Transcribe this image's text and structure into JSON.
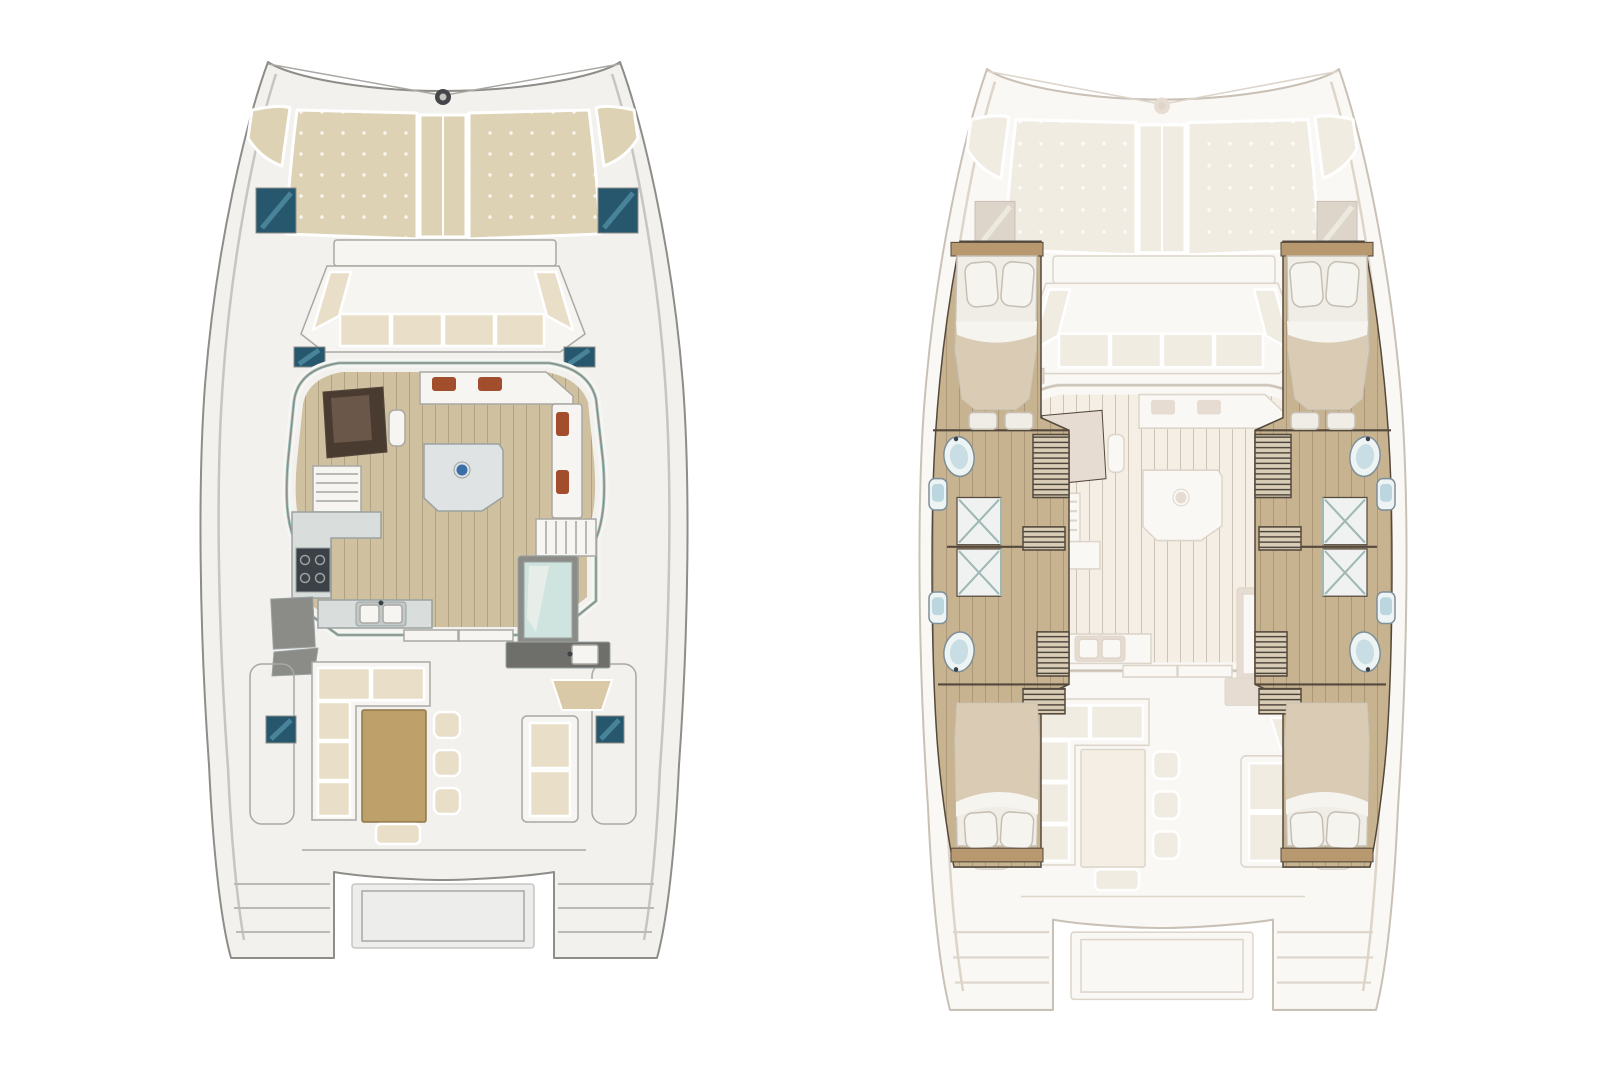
{
  "colors": {
    "background": "#ffffff",
    "hull_fill": "#f2f1ee",
    "hull_line": "#8e8d88",
    "inner_line": "#c6c5c0",
    "detail_line": "#a9a8a3",
    "tread": "#b9b9b5",
    "sunpad": "#ddd2b4",
    "sunpad_line": "#ffffff",
    "hatch_dark": "#26576d",
    "hatch_light": "#4f8ba1",
    "bench_white": "#f6f5f2",
    "cushion": "#e9dfc9",
    "cushion_line": "#ffffff",
    "wood_floor": "#cfc0a0",
    "hull_wood": "#c8b390",
    "plank_line": "rgba(100,82,58,0.28)",
    "window_teal": "#9fc4be",
    "nav_dark": "#4a3b31",
    "nav_panel": "#6b564a",
    "counter": "#d9dedd",
    "counter_line": "#9aa2a1",
    "appliance": "#3c4147",
    "steel": "#c2cac9",
    "table_gray": "#dfe3e3",
    "table_dot_blue": "#3a6ea8",
    "accent_rust": "#a24e2c",
    "wood_table": "#bda06a",
    "wood_table_line": "#8f7748",
    "glass": "#cfe4df",
    "gray_box": "#8b8b87",
    "wetbar": "#6e6e6a",
    "helm_seat": "#d9c9a6",
    "platform": "#ededeb",
    "bow_fitting": "#46464a",
    "wall_dark": "#54493d",
    "step_line": "#4e463c",
    "locker_fill": "#d9cdb6",
    "mattress": "#f0ede6",
    "pillow": "#f6f4ef",
    "pillow_line": "#c6c0b4",
    "blanket": "#d9cbb4",
    "headboard": "#b8996f",
    "fixture_white": "#eef4f4",
    "fixture_blue": "#bcd6e0",
    "fixture_line": "#7d9098",
    "shower_fill": "#f0f2f1",
    "shower_glass": "#9fb8b4",
    "faded_fill": "#faf8f5",
    "faded_line": "#c9c1b6",
    "faded_detail": "#ddd5ca",
    "faded_soft": "#f1ece2",
    "faded_wood": "#f4eee5",
    "faded_accent": "#e7dcd2"
  }
}
